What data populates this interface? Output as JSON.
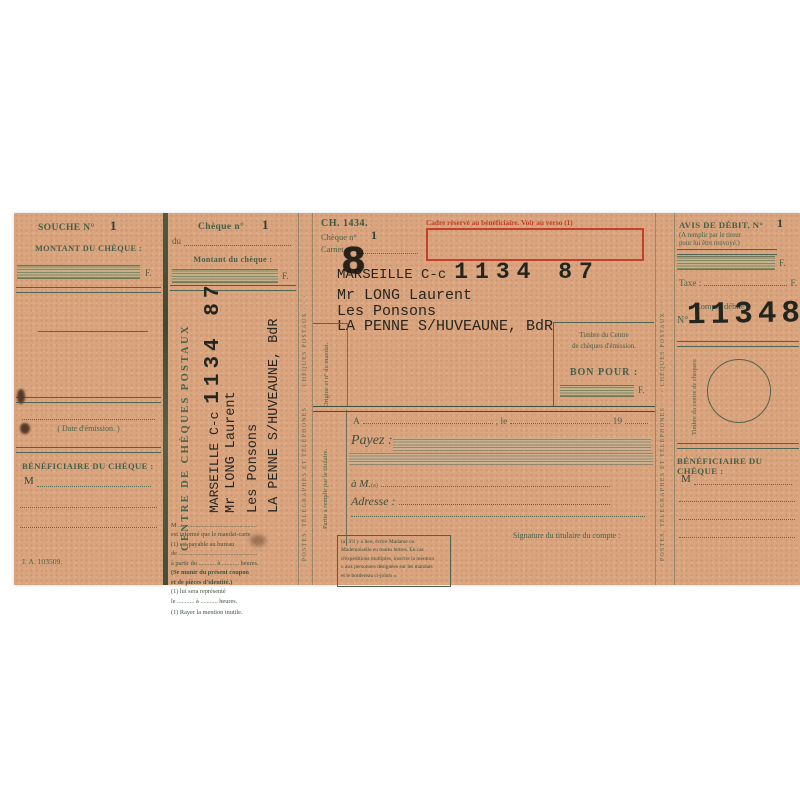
{
  "colors": {
    "paper": "#d9a47e",
    "print_green": "#48644b",
    "typed_black": "#26251f",
    "red": "#c23f27"
  },
  "souche": {
    "title": "SOUCHE N°",
    "number": "1",
    "montant_label": "MONTANT DU CHÈQUE :",
    "currency": "F.",
    "date_caption": "( Date d'émission. )",
    "beneficiaire_label": "BÉNÉFICIAIRE DU CHÈQUE :",
    "civility": "M",
    "imprint": "J. A. 103509."
  },
  "coupon": {
    "cheque_label": "Chèque n°",
    "number": "1",
    "du_label": "du",
    "montant_label": "Montant du chèque :",
    "currency": "F.",
    "vertical_title": "CENTRE DE CHÈQUES POSTAUX",
    "typed_city": "MARSEILLE C-c",
    "typed_account": "1134 87",
    "typed_name": "Mr LONG Laurent",
    "typed_address1": "Les Ponsons",
    "typed_address2": "LA PENNE S/HUVEAUNE, BdR",
    "notice_lines": [
      "M ..................................................",
      "est informé que le mandat-carte",
      "(1) est payable au bureau",
      "de ..................................................",
      "à partir du ........... à ........... heures.",
      "(Se munir du présent coupon",
      "et de pièces d'identité.)",
      "(1) lui sera représenté",
      "le ........... à ........... heures.",
      "(1) Rayer la mention inutile."
    ]
  },
  "strip": {
    "text": "· POSTES, TÉLÉGRAPHES ET TÉLÉPHONES · · · CHÈQUES POSTAUX · · ·"
  },
  "cheque": {
    "form_ref": "CH. 1434.",
    "cheque_label": "Chèque n°",
    "number": "1",
    "carnet_label": "Carnet n°",
    "red_notice": "Cadre réservé au bénéficiaire. Voir au verso (1)",
    "typed_city": "MARSEILLE C-c",
    "typed_account": "1134 87",
    "stamp_digit": "8",
    "typed_name": "Mr LONG Laurent",
    "typed_address1": "Les Ponsons",
    "typed_address2": "LA PENNE S/HUVEAUNE, BdR",
    "timbre_line1": "Timbre du Centre",
    "timbre_line2": "de chèques d'émission.",
    "bon_pour_label": "BON POUR :",
    "currency": "F.",
    "origine_label": "Origine et n° du mandat.",
    "partie_label": "Partie à remplir par le titulaire.",
    "a_label": "A",
    "le_label": ", le",
    "year_prefix": "19",
    "payez_label": "Payez :",
    "am_label": "à M.",
    "am_sup": "(a)",
    "adresse_label": "Adresse :",
    "signature_label": "Signature du titulaire du compte :",
    "footnote_lines": [
      "(a) S'il y a lieu, écrire Madame ou",
      "Mademoiselle en toutes lettres. En cas",
      "d'expéditions multiples, inscrire la mention",
      "« aux personnes désignées sur les mandats",
      "et le bordereau ci-joints »."
    ]
  },
  "avis": {
    "title": "AVIS DE DÉBIT, N°",
    "number": "1",
    "sub_line1": "(A remplir par le tireur",
    "sub_line2": "pour lui être renvoyé.)",
    "currency": "F.",
    "taxe_label": "Taxe :",
    "compte_label": "Compte débité :",
    "no_label": "N°",
    "account_number": "113487",
    "timbre_label": "Timbre du centre de chèques:",
    "beneficiaire_label": "BÉNÉFICIAIRE DU CHÈQUE :",
    "civility": "M"
  }
}
